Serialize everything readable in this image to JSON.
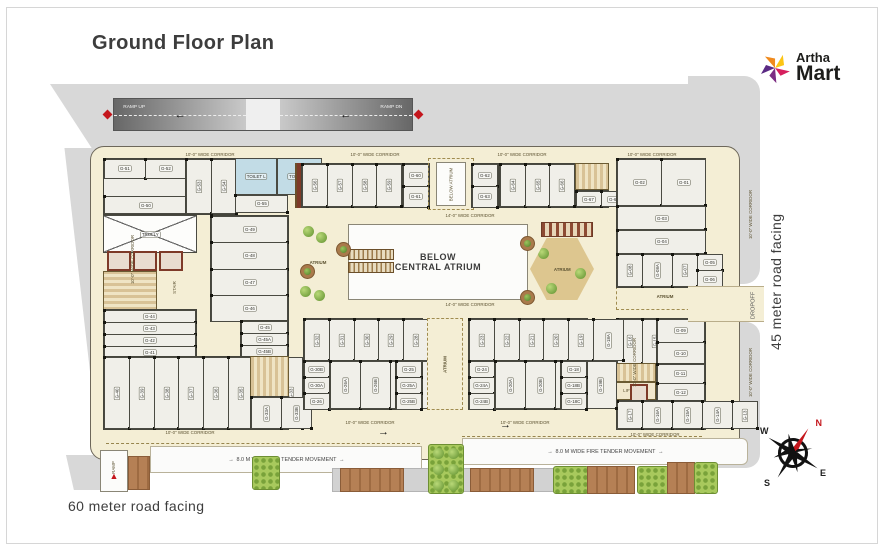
{
  "title": "Ground Floor Plan",
  "logo": {
    "top": "Artha",
    "bottom": "Mart"
  },
  "roads": {
    "bottom": "60 meter road facing",
    "right": "45 meter road facing",
    "dropoff": "DROPOFF"
  },
  "ramp": {
    "up": "RAMP UP",
    "dn": "RAMP DN",
    "bottom": "RAMP"
  },
  "fire": {
    "label": "8.0 M WIDE FIRE TENDER MOVEMENT"
  },
  "arrows": {
    "left": "←",
    "right": "→",
    "up": "▲"
  },
  "corridors": {
    "w10": "10'-0\" WIDE CORRIDOR",
    "w14": "14'-0\" WIDE CORRIDOR"
  },
  "areas": {
    "atrium": "ATRIUM",
    "below_atrium": "BELOW ATRIUM",
    "below_central_atrium_1": "BELOW",
    "below_central_atrium_2": "CENTRAL ATRIUM",
    "toilet_l": "TOILET L",
    "toilet_g": "TOILET G",
    "trolly": "TROLLY",
    "stair": "STAIR",
    "lift_lobby": "LIFT LOBBY"
  },
  "compass": {
    "n": "N",
    "e": "E",
    "s": "S",
    "w": "W"
  },
  "west": {
    "top_small": [
      "G-51",
      "G-52"
    ],
    "top_wide": "G-50",
    "top_mid": [
      "G-53",
      "G-54"
    ],
    "toilet_wide": "G-55",
    "left_wides": [
      "G-44",
      "G-43",
      "G-42",
      "G-41"
    ],
    "right_wides": [
      "G-49",
      "G-48",
      "G-47",
      "G-46"
    ],
    "right_stack": [
      "G-45",
      "G-45A",
      "G-45B"
    ],
    "bottom": [
      "G-40",
      "G-39",
      "G-38",
      "G-37",
      "G-36",
      "G-35",
      "G-34",
      "G-33"
    ],
    "corner": [
      "G-33A",
      "G-33B"
    ]
  },
  "topcenter": {
    "left_units": [
      "G-56",
      "G-57",
      "G-58",
      "G-59"
    ],
    "left_stack": [
      "G-60",
      "G-61"
    ],
    "right_stack": [
      "G-62",
      "G-63"
    ],
    "right_units": [
      "G-64",
      "G-65",
      "G-66"
    ],
    "right_small": [
      "G-67",
      "G-68"
    ]
  },
  "east": {
    "r1": [
      "G-02",
      "G-01"
    ],
    "r2": "G-03",
    "r3": "G-04",
    "r4": [
      "G-08",
      "G-08A",
      "G-07"
    ],
    "r4_stack": [
      "G-05",
      "G-06"
    ],
    "low_top": [
      "G-16",
      "G-15",
      "G-14"
    ],
    "low_right_top": [
      "G-09",
      "G-10"
    ],
    "low_right_bot": [
      "G-11",
      "G-12"
    ],
    "low_bottom": [
      "G-17",
      "G-16A",
      "G-15A",
      "G-14A",
      "G-13"
    ]
  },
  "bottomcenter": {
    "left": {
      "top": [
        "G-32",
        "G-31",
        "G-30",
        "G-29",
        "G-28",
        "G-27"
      ],
      "lstack": [
        "G-30B",
        "G-30A",
        "G-26"
      ],
      "mid": [
        "G-26A",
        "G-26B",
        "G-25C",
        "G-25D"
      ],
      "rstack": [
        "G-25",
        "G-25A",
        "G-25B"
      ]
    },
    "right": {
      "top": [
        "G-23",
        "G-22",
        "G-21",
        "G-20",
        "G-19",
        "G-18A"
      ],
      "lstack": [
        "G-24",
        "G-24A",
        "G-24B"
      ],
      "mid": [
        "G-20A",
        "G-20B",
        "G-19A",
        "G-19B"
      ],
      "rstack": [
        "G-18",
        "G-18B",
        "G-18C"
      ]
    }
  },
  "colors": {
    "accent_red": "#c4161c",
    "building_cream": "#f4eed5",
    "road_gray": "#d8d8d8",
    "wall": "#4a4a42",
    "green": "#a8c95d",
    "paver_brown": "#a9744a",
    "toilet_blue": "#c2dce6",
    "lift_maroon": "#7e3a28"
  }
}
